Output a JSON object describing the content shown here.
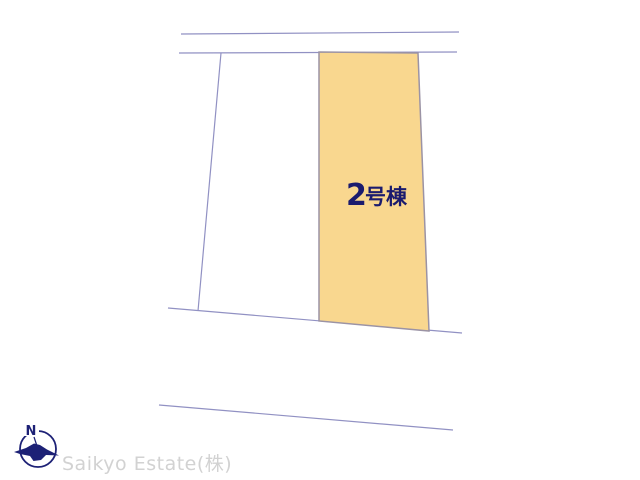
{
  "page": {
    "background_color": "#ffffff"
  },
  "site_plan": {
    "line_color": "#9191c3",
    "highlighted_parcel": {
      "label_number": "2",
      "label_suffix": "号棟",
      "label_color": "#1b1b6e",
      "fill_color": "#f9d78f",
      "border_color": "#9b93a5"
    }
  },
  "compass": {
    "north_letter": "N",
    "color": "#1d2176"
  },
  "watermark": {
    "text": "Saikyo Estate(株)",
    "color": "#d2d2d2"
  }
}
